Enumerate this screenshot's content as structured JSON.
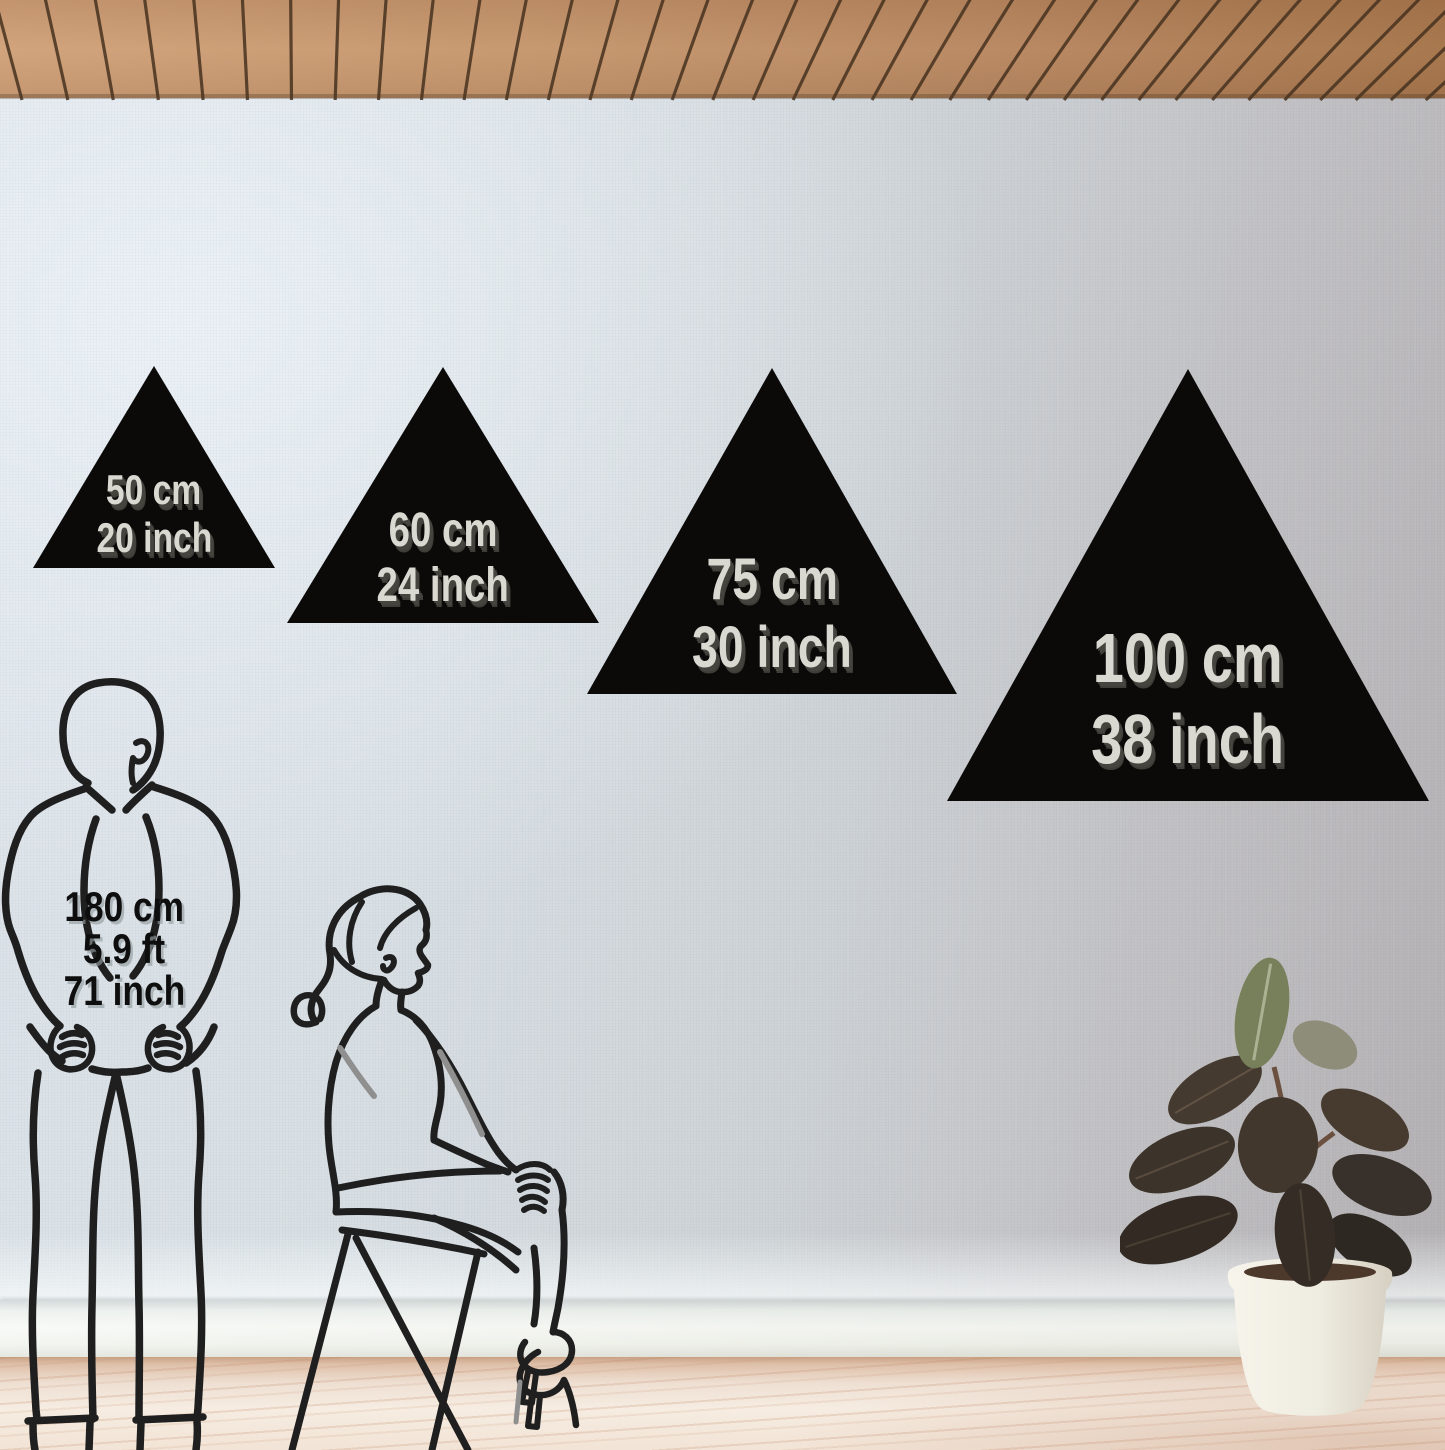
{
  "product_mockup": {
    "description": "triangle-wall-decor-size-comparison",
    "sizes": [
      {
        "cm": "50 cm",
        "inch": "20 inch"
      },
      {
        "cm": "60 cm",
        "inch": "24 inch"
      },
      {
        "cm": "75 cm",
        "inch": "30 inch"
      },
      {
        "cm": "100 cm",
        "inch": "38 inch"
      }
    ],
    "human_reference": {
      "height_cm": "180 cm",
      "height_ft": "5.9 ft",
      "height_inch": "71 inch"
    }
  },
  "scene": {
    "elements": [
      "wood-slat-ceiling",
      "linen-textured-wall",
      "white-baseboard",
      "light-wood-floor",
      "standing-man-line-art",
      "sitting-woman-line-art",
      "potted-rubber-plant"
    ],
    "colors": {
      "triangle_fill": "#0b0a09",
      "triangle_text": "#d9d8d1",
      "triangle_text_shadow": "#45443e",
      "wall_left": "#dde4ea",
      "wall_right": "#b2afb1",
      "ceiling_wood_light": "#d2a47d",
      "ceiling_wood_dark": "#a8784f",
      "ceiling_gap": "#47321f",
      "floor_wood": "#f0e2d4",
      "baseboard": "#f6f8f4",
      "line_art": "#1f1f1f",
      "accent_gray_stroke": "#8f8f8f",
      "pot": "#f3f0e8",
      "soil": "#4d392c",
      "leaf_dark": "#3a332b",
      "leaf_green": "#77805a"
    }
  }
}
